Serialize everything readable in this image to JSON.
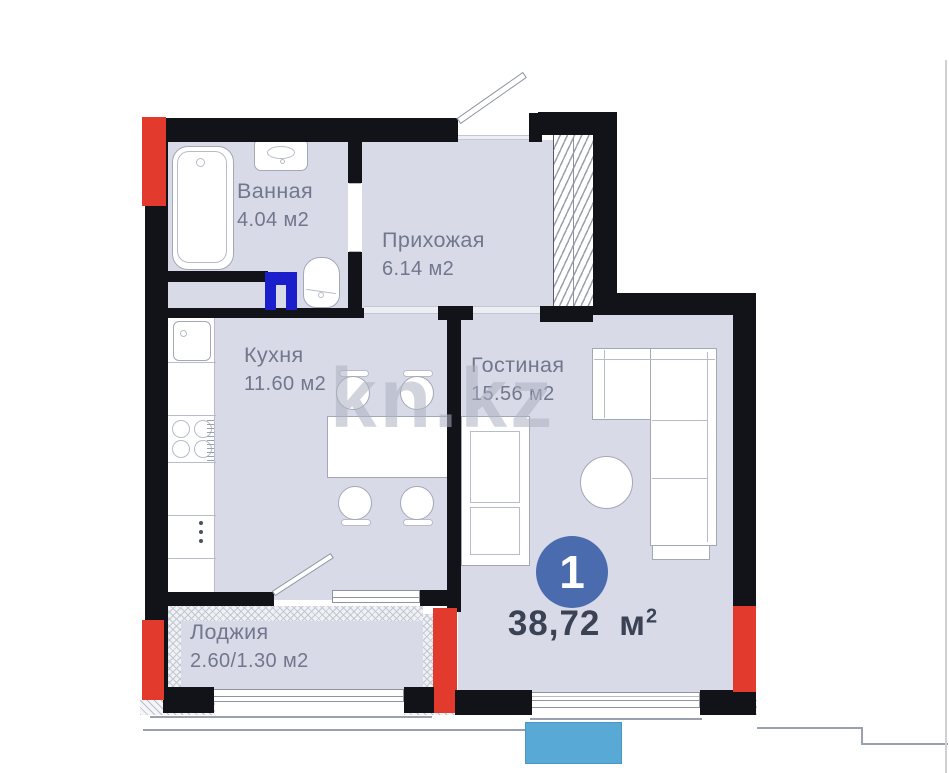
{
  "watermark": "kn.kz",
  "badge": {
    "count": "1"
  },
  "total": {
    "value": "38,72",
    "unit": "м",
    "sup": "2"
  },
  "rooms": {
    "bathroom": {
      "name": "Ванная",
      "area": "4.04 м2"
    },
    "hallway": {
      "name": "Прихожая",
      "area": "6.14 м2"
    },
    "kitchen": {
      "name": "Кухня",
      "area": "11.60 м2"
    },
    "living": {
      "name": "Гостиная",
      "area": "15.56 м2"
    },
    "loggia": {
      "name": "Лоджия",
      "area": "2.60/1.30 м2"
    }
  },
  "colors": {
    "wall": "#111318",
    "floor": "#d8dae8",
    "red": "#e23b2e",
    "door_frame_blue": "#1a1ecb",
    "badge_blue": "#4a6bad",
    "marker_blue": "#58a9d6",
    "label_color": "#71778c",
    "total_text": "#3a4254"
  }
}
